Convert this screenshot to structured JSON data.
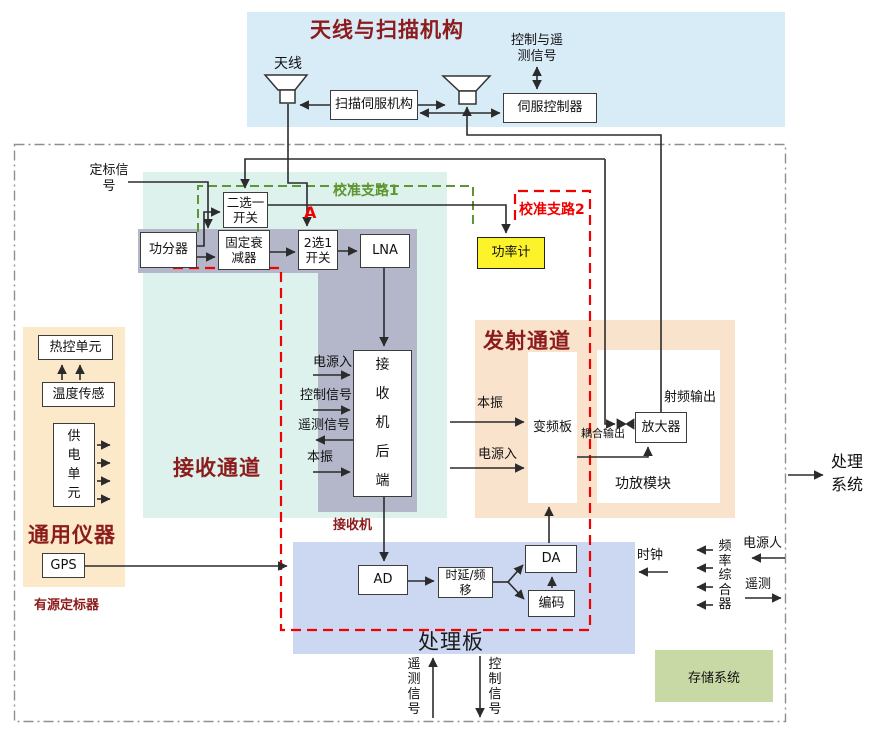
{
  "antenna_section": {
    "title": "天线与扫描机构",
    "antenna_label": "天线",
    "scan_servo": "扫描伺服机构",
    "servo_controller": "伺服控制器",
    "ctrl_telemetry": "控制与遥\n测信号"
  },
  "calibration": {
    "cal_signal": "定标信\n号",
    "branch1": "校准支路1",
    "branch2": "校准支路2",
    "point_a": "A"
  },
  "receive": {
    "title": "接收通道",
    "power_divider": "功分器",
    "fixed_attenuator": "固定衰\n减器",
    "switch_two_select": "二选一\n开关",
    "switch_2to1": "2选1\n开关",
    "lna": "LNA",
    "power_meter": "功率计",
    "receiver_label": "接收机",
    "backend": "接\n收\n机\n后\n端",
    "in_power": "电源入",
    "in_control": "控制信号",
    "out_telemetry": "遥测信号",
    "in_lo": "本振"
  },
  "instruments": {
    "title": "通用仪器",
    "thermal_unit": "热控单元",
    "temp_sensor": "温度传感",
    "power_supply": "供\n电\n单\n元",
    "gps": "GPS",
    "active_calibrator": "有源定标器"
  },
  "transmit": {
    "title": "发射通道",
    "lo_in": "本振",
    "power_in": "电源入",
    "converter": "变频板",
    "amplifier": "放大器",
    "rf_out": "射频输出",
    "coupled_out": "耦合输出",
    "pa_module": "功放模块"
  },
  "processing": {
    "title": "处理板",
    "ad": "AD",
    "delay_shift": "时延/频\n移",
    "da": "DA",
    "encoder": "编码",
    "clock": "时钟",
    "telemetry_signal": "遥\n测\n信\n号",
    "control_signal": "控\n制\n信\n号"
  },
  "right_side": {
    "freq_synth": "频\n率\n综\n合\n器",
    "power_in": "电源人",
    "telemetry": "遥测",
    "processing_system": "处理\n系统"
  },
  "storage": {
    "label": "存储系统"
  },
  "colors": {
    "section_dark_red": "#8c1c1c",
    "branch1_green": "#5e9732",
    "branch2_red": "#f20000",
    "power_meter_yellow": "#fdf32b",
    "antenna_panel_blue": "#d8ecf8",
    "receive_cyan": "#ddf1ed",
    "receiver_gray": "#b4b7ca",
    "instruments_cream": "#fce9c9",
    "transmit_peach": "#fae3cd",
    "processing_periwinkle": "#ccd7f1",
    "storage_green": "#c8d9a6"
  }
}
